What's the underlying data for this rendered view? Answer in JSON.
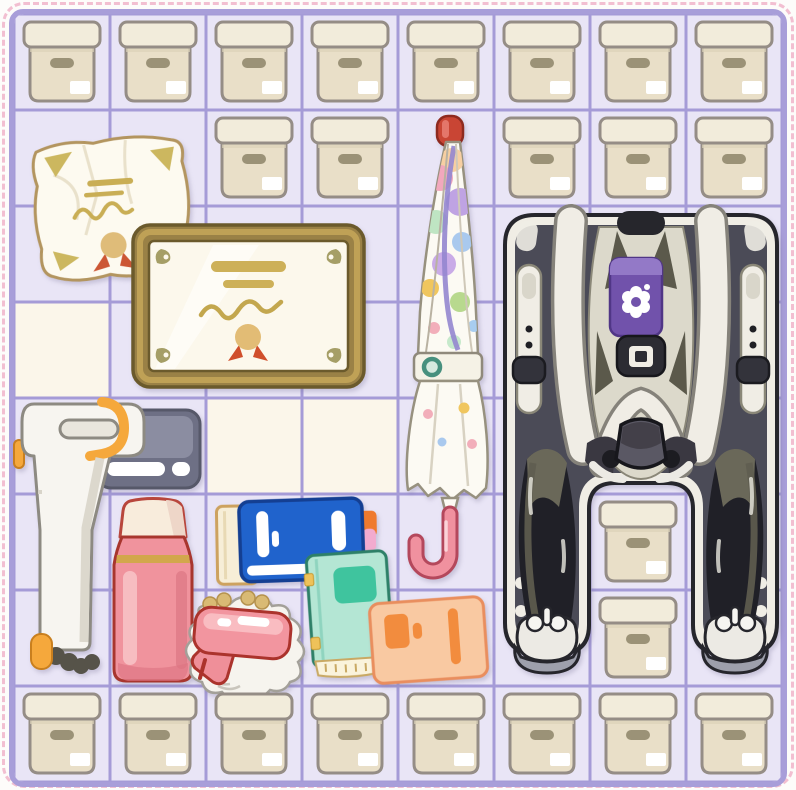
{
  "scene": {
    "title": "Storage room organizing grid",
    "description": "Top-down puzzle grid filled with moving boxes and household items"
  },
  "palette": {
    "page_bg": "#fdfcfa",
    "dashed_border": "#f2bfd1",
    "grid_border": "#a89ed9",
    "grid_line": "#a59bd7",
    "cell": "#e9e5f6",
    "cell_alt": "#fbf6ea"
  },
  "grid": {
    "cols": 8,
    "rows": 8,
    "cell_px": 96,
    "origin_px": 14,
    "alt_cells": [
      [
        4,
        1
      ],
      [
        5,
        3
      ],
      [
        5,
        4
      ]
    ]
  },
  "boxes": {
    "label": "storage box",
    "count": 23,
    "colors": {
      "outline": "#958d86",
      "lid": "#f2ecdb",
      "body": "#e9dfc8",
      "handle": "#9b9277",
      "sticker": "#ffffff"
    },
    "cells": [
      [
        1,
        1
      ],
      [
        1,
        2
      ],
      [
        1,
        3
      ],
      [
        1,
        4
      ],
      [
        1,
        5
      ],
      [
        1,
        6
      ],
      [
        1,
        7
      ],
      [
        1,
        8
      ],
      [
        2,
        3
      ],
      [
        2,
        4
      ],
      [
        2,
        6
      ],
      [
        2,
        7
      ],
      [
        2,
        8
      ],
      [
        6,
        7
      ],
      [
        7,
        7
      ],
      [
        8,
        1
      ],
      [
        8,
        2
      ],
      [
        8,
        3
      ],
      [
        8,
        4
      ],
      [
        8,
        5
      ],
      [
        8,
        6
      ],
      [
        8,
        7
      ],
      [
        8,
        8
      ]
    ]
  },
  "items": [
    {
      "id": "crumpled-certificate",
      "label": "crumpled certificate paper",
      "bbox": [
        12,
        117,
        176,
        154
      ],
      "rotation": -2,
      "colors": {
        "paper": "#fdfaf0",
        "gold": "#c9ae55",
        "seal": "#dfbc79",
        "ribbon": "#cc5634",
        "outline": "#b3955f"
      }
    },
    {
      "id": "framed-certificate",
      "label": "framed certificate",
      "bbox": [
        117,
        209,
        235,
        166
      ],
      "rotation": 0,
      "colors": {
        "frame": "#9a8146",
        "bevel": "#bfa156",
        "paper": "#fcf8ec",
        "gold": "#cdb058",
        "ribbon": "#d04f2c"
      }
    },
    {
      "id": "stick-vacuum",
      "label": "cordless stick vacuum",
      "bbox": [
        0,
        382,
        196,
        288
      ],
      "rotation": 0,
      "colors": {
        "body": "#f7f5f0",
        "canister": "#6e7085",
        "accent": "#f5a83c",
        "brush": "#565349"
      }
    },
    {
      "id": "thermos",
      "label": "pink thermos flask",
      "bbox": [
        96,
        481,
        86,
        191
      ],
      "rotation": 0,
      "colors": {
        "body": "#f0939d",
        "cap": "#f8ecdc",
        "band": "#d2a74c",
        "outline": "#a8362e"
      }
    },
    {
      "id": "blue-book",
      "label": "blue book on cream notebook with tabs",
      "bbox": [
        198,
        480,
        168,
        96
      ],
      "rotation": -1,
      "colors": {
        "cover": "#2063cc",
        "outline": "#143f92",
        "under_book": "#f7eed7",
        "tab_orange": "#ef7a2e",
        "tab_pink": "#f2abcf"
      }
    },
    {
      "id": "teal-book",
      "label": "mint green notebook",
      "bbox": [
        290,
        533,
        92,
        132
      ],
      "rotation": -2,
      "colors": {
        "cover": "#b4e6d4",
        "label": "#3fc49e",
        "outline": "#2e8068",
        "pages": "#faf3dc"
      }
    },
    {
      "id": "hair-dryer",
      "label": "pink hair dryer on lace doily",
      "bbox": [
        158,
        576,
        140,
        116
      ],
      "rotation": 0,
      "colors": {
        "body": "#f2959f",
        "outline": "#ab332c",
        "doily": "#f6f4ee",
        "lace": "#d9ba74"
      }
    },
    {
      "id": "orange-book",
      "label": "peach orange book",
      "bbox": [
        356,
        582,
        120,
        100
      ],
      "rotation": -2,
      "colors": {
        "cover": "#f9c9a2",
        "label": "#f28c3e",
        "outline": "#e98e5e"
      }
    },
    {
      "id": "closed-umbrella",
      "label": "closed pastel polka-dot umbrella",
      "bbox": [
        388,
        98,
        96,
        470
      ],
      "rotation": 0,
      "colors": {
        "body": "#fcfaf3",
        "tip": "#c94534",
        "handle": "#f0919f",
        "button": "#47907e",
        "dots": [
          "#f2a8bd",
          "#bfa3e3",
          "#f0c65e",
          "#b8d98e",
          "#a9c9ee",
          "#f7cfa2",
          "#bfe5c3"
        ]
      }
    },
    {
      "id": "baby-stroller",
      "label": "baby stroller with harness seat",
      "bbox": [
        487,
        197,
        280,
        467
      ],
      "rotation": 0,
      "colors": {
        "frame_dark": "#4b4b57",
        "frame_light": "#f0ede5",
        "outline": "#26262c",
        "pad": "#7152ab",
        "straps": "#f0ede5",
        "legs": "#202027",
        "shoes": "#eceae4"
      }
    }
  ]
}
